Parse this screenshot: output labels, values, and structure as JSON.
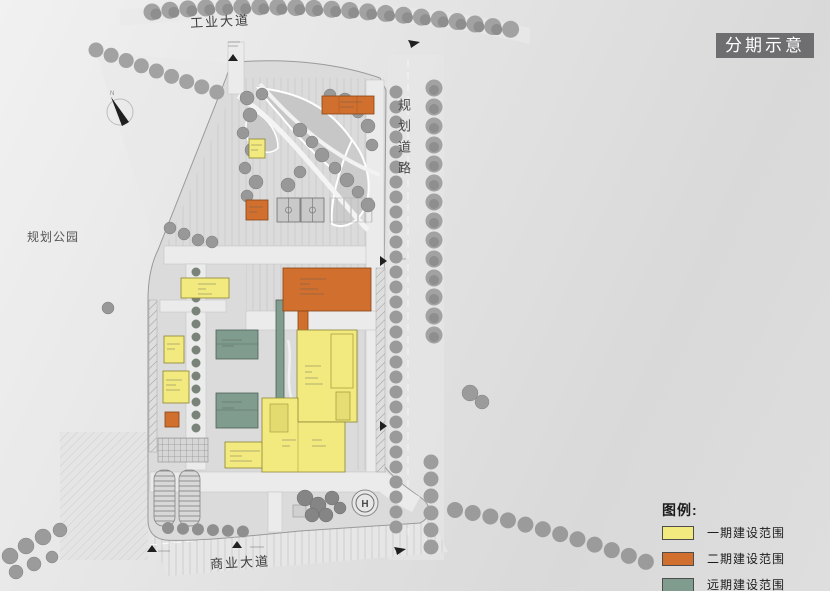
{
  "title_badge": {
    "label": "分期示意",
    "bg": "#6e6e70",
    "fg": "#ffffff"
  },
  "surroundings": {
    "north_road": "工业大道",
    "east_road": "规划道路",
    "west_area": "规划公园",
    "south_road": "商业大道"
  },
  "legend": {
    "title": "图例:",
    "items": [
      {
        "label": "一期建设范围",
        "color": "#f2ea7e"
      },
      {
        "label": "二期建设范围",
        "color": "#d1702e"
      },
      {
        "label": "远期建设范围",
        "color": "#7f9c8e"
      }
    ]
  },
  "plan": {
    "compass_label": "N",
    "helipad_label": "H"
  },
  "colors": {
    "phase1": "#f2ea7e",
    "phase2": "#d1702e",
    "phase3": "#7f9c8e",
    "site_fill": "#dcdcdc",
    "road_fill": "#ececec",
    "tree_gray": "#9a9a9a"
  }
}
